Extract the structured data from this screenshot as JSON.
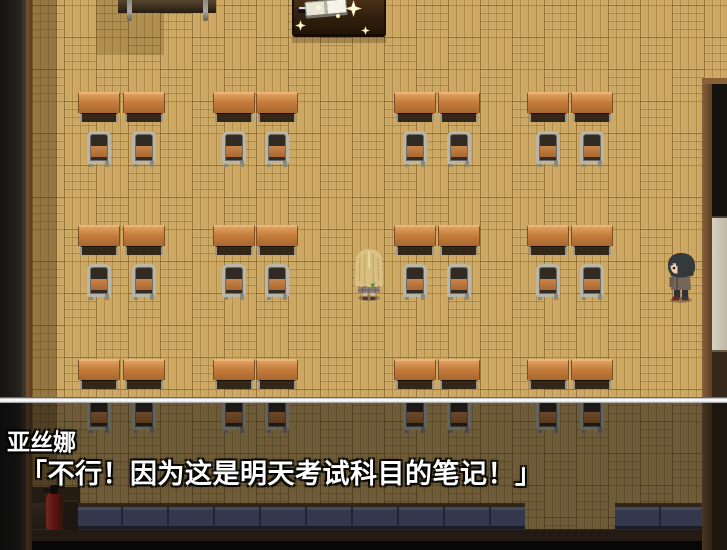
{
  "dialogue": {
    "speaker": "亚丝娜",
    "text": "「不行！因为这是明天考试科目的笔记！」"
  },
  "palette": {
    "floor_wood": "#cda862",
    "desk_wood": "#c47c3c",
    "chair_metal": "#b9b6a8",
    "locker_blue_gray": "#5d678a",
    "fire_extinguisher_red": "#a82418",
    "sparkle_gold": "#eec85e",
    "message_text": "#ffffff",
    "message_border": "#ffffff",
    "message_dim": "rgba(0,0,0,0.47)"
  },
  "scene": {
    "objects": [
      "blackboard-edge",
      "teacher-desk",
      "open-book",
      "sparkles",
      "student-desks",
      "student-chairs",
      "asuna-sprite",
      "kirito-sprite",
      "fire-extinguisher",
      "locker-row",
      "side-door-panel",
      "message-window"
    ]
  }
}
